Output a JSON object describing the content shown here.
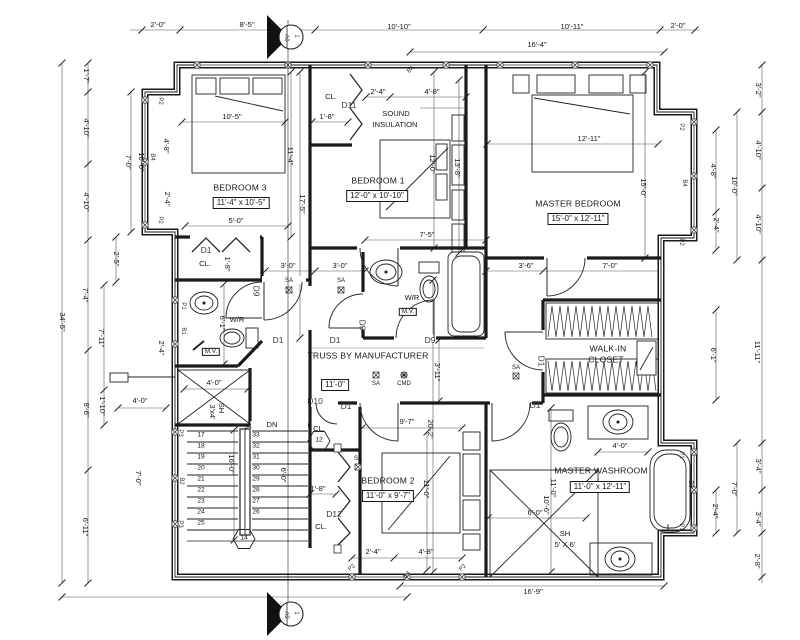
{
  "drawing": {
    "type": "architectural-floor-plan",
    "ink_color": "#1a1a1a",
    "paper_color": "#ffffff",
    "section_marker": {
      "number": "1",
      "sheet": "A9"
    }
  },
  "labels": [
    {
      "t": "BEDROOM 3",
      "x": 240,
      "y": 188,
      "c": "room",
      "n": "room-label-bedroom-3"
    },
    {
      "t": "11'-4\" x 10'-5\"",
      "x": 241,
      "y": 203,
      "c": "roombox",
      "n": "room-size-bedroom-3"
    },
    {
      "t": "BEDROOM 1",
      "x": 378,
      "y": 181,
      "c": "room",
      "n": "room-label-bedroom-1"
    },
    {
      "t": "12'-0\" x 10'-10\"",
      "x": 377,
      "y": 196,
      "c": "roombox",
      "n": "room-size-bedroom-1"
    },
    {
      "t": "MASTER BEDROOM",
      "x": 578,
      "y": 204,
      "c": "room",
      "n": "room-label-master-bedroom"
    },
    {
      "t": "15'-0\" x 12'-11\"",
      "x": 578,
      "y": 219,
      "c": "roombox",
      "n": "room-size-master-bedroom"
    },
    {
      "t": "BEDROOM 2",
      "x": 388,
      "y": 481,
      "c": "room",
      "n": "room-label-bedroom-2"
    },
    {
      "t": "11'-0\" x 9'-7\"",
      "x": 388,
      "y": 496,
      "c": "roombox",
      "n": "room-size-bedroom-2"
    },
    {
      "t": "MASTER WASHROOM",
      "x": 601,
      "y": 471,
      "c": "room",
      "n": "room-label-master-washroom"
    },
    {
      "t": "11'-0\" x 12'-11\"",
      "x": 600,
      "y": 487,
      "c": "roombox",
      "n": "room-size-master-washroom"
    },
    {
      "t": "WALK-IN",
      "x": 608,
      "y": 349,
      "c": "room",
      "n": "room-label-walk-in-closet"
    },
    {
      "t": "CLOSET",
      "x": 606,
      "y": 360,
      "c": "room"
    },
    {
      "t": "SOUND",
      "x": 396,
      "y": 114,
      "c": "dim",
      "n": "note-sound-insulation"
    },
    {
      "t": "INSULATION",
      "x": 395,
      "y": 125,
      "c": "dim"
    },
    {
      "t": "TRUSS BY MANUFACTURER",
      "x": 368,
      "y": 356,
      "c": "room",
      "n": "note-truss"
    },
    {
      "t": "11'-0\"",
      "x": 335,
      "y": 385,
      "c": "roombox",
      "n": "hall-width-dim"
    },
    {
      "t": "2'-0\"",
      "x": 158,
      "y": 25,
      "c": "dim"
    },
    {
      "t": "8'-5\"",
      "x": 247,
      "y": 25,
      "c": "dim"
    },
    {
      "t": "10'-10\"",
      "x": 399,
      "y": 27,
      "c": "dim"
    },
    {
      "t": "10'-11\"",
      "x": 572,
      "y": 27,
      "c": "dim"
    },
    {
      "t": "2'-0\"",
      "x": 678,
      "y": 26,
      "c": "dim"
    },
    {
      "t": "16'-4\"",
      "x": 537,
      "y": 45,
      "c": "dim"
    },
    {
      "t": "1'-7\"",
      "x": 86,
      "y": 76,
      "c": "dim",
      "r": 90
    },
    {
      "t": "4'-10\"",
      "x": 86,
      "y": 128,
      "c": "dim",
      "r": 90
    },
    {
      "t": "4'-10\"",
      "x": 86,
      "y": 202,
      "c": "dim",
      "r": 90
    },
    {
      "t": "7'-4\"",
      "x": 85,
      "y": 295,
      "c": "dim",
      "r": 90
    },
    {
      "t": "8'-6\"",
      "x": 86,
      "y": 410,
      "c": "dim",
      "r": 90
    },
    {
      "t": "6'-11\"",
      "x": 85,
      "y": 527,
      "c": "dim",
      "r": 90
    },
    {
      "t": "34'-5\"",
      "x": 62,
      "y": 322,
      "c": "dim",
      "r": 90
    },
    {
      "t": "2'-5\"",
      "x": 116,
      "y": 259,
      "c": "dim",
      "r": 90
    },
    {
      "t": "7'-11\"",
      "x": 101,
      "y": 338,
      "c": "dim",
      "r": 90
    },
    {
      "t": "1'-10\"",
      "x": 102,
      "y": 406,
      "c": "dim",
      "r": 90
    },
    {
      "t": "7'-0\"",
      "x": 128,
      "y": 162,
      "c": "dim",
      "r": 90
    },
    {
      "t": "10'-0\"",
      "x": 141,
      "y": 162,
      "c": "dim",
      "r": 90
    },
    {
      "t": "4'-8\"",
      "x": 166,
      "y": 146,
      "c": "dim",
      "r": 90
    },
    {
      "t": "2'-4\"",
      "x": 167,
      "y": 199,
      "c": "dim",
      "r": 90
    },
    {
      "t": "2'-4\"",
      "x": 161,
      "y": 348,
      "c": "dim",
      "r": 90
    },
    {
      "t": "7'-0\"",
      "x": 138,
      "y": 478,
      "c": "dim",
      "r": 90
    },
    {
      "t": "4'-0\"",
      "x": 140,
      "y": 401,
      "c": "dim"
    },
    {
      "t": "3'-2\"",
      "x": 758,
      "y": 90,
      "c": "dim",
      "r": 90
    },
    {
      "t": "4'-10\"",
      "x": 758,
      "y": 150,
      "c": "dim",
      "r": 90
    },
    {
      "t": "4'-10\"",
      "x": 758,
      "y": 224,
      "c": "dim",
      "r": 90
    },
    {
      "t": "11'-11\"",
      "x": 757,
      "y": 352,
      "c": "dim",
      "r": 90
    },
    {
      "t": "3'-4\"",
      "x": 758,
      "y": 466,
      "c": "dim",
      "r": 90
    },
    {
      "t": "3'-4\"",
      "x": 758,
      "y": 519,
      "c": "dim",
      "r": 90
    },
    {
      "t": "2'-8\"",
      "x": 757,
      "y": 561,
      "c": "dim",
      "r": 90
    },
    {
      "t": "10'-0\"",
      "x": 734,
      "y": 186,
      "c": "dim",
      "r": 90
    },
    {
      "t": "7'-0\"",
      "x": 734,
      "y": 489,
      "c": "dim",
      "r": 90
    },
    {
      "t": "4'-8\"",
      "x": 713,
      "y": 171,
      "c": "dim",
      "r": 90
    },
    {
      "t": "2'-4\"",
      "x": 716,
      "y": 225,
      "c": "dim",
      "r": 90
    },
    {
      "t": "6'-1\"",
      "x": 713,
      "y": 355,
      "c": "dim",
      "r": 90
    },
    {
      "t": "2'-4\"",
      "x": 715,
      "y": 511,
      "c": "dim",
      "r": 90
    },
    {
      "t": "16'-9\"",
      "x": 533,
      "y": 592,
      "c": "dim"
    },
    {
      "t": "2'-4\"",
      "x": 373,
      "y": 552,
      "c": "dim"
    },
    {
      "t": "4'-8\"",
      "x": 426,
      "y": 552,
      "c": "dim"
    },
    {
      "t": "2'-4\"",
      "x": 378,
      "y": 92,
      "c": "dim"
    },
    {
      "t": "4'-8\"",
      "x": 432,
      "y": 92,
      "c": "dim"
    },
    {
      "t": "10'-5\"",
      "x": 232,
      "y": 117,
      "c": "dim"
    },
    {
      "t": "1'-8\"",
      "x": 327,
      "y": 117,
      "c": "dim"
    },
    {
      "t": "5'-0\"",
      "x": 236,
      "y": 221,
      "c": "dim"
    },
    {
      "t": "7'-5\"",
      "x": 427,
      "y": 235,
      "c": "dim"
    },
    {
      "t": "12'-11\"",
      "x": 589,
      "y": 139,
      "c": "dim"
    },
    {
      "t": "3'-0\"",
      "x": 288,
      "y": 266,
      "c": "dim"
    },
    {
      "t": "3'-0\"",
      "x": 340,
      "y": 266,
      "c": "dim"
    },
    {
      "t": "3'-6\"",
      "x": 526,
      "y": 266,
      "c": "dim"
    },
    {
      "t": "7'-0\"",
      "x": 610,
      "y": 266,
      "c": "dim"
    },
    {
      "t": "9'-7\"",
      "x": 407,
      "y": 422,
      "c": "dim"
    },
    {
      "t": "4'-0\"",
      "x": 214,
      "y": 383,
      "c": "dim"
    },
    {
      "t": "4'-0\"",
      "x": 620,
      "y": 446,
      "c": "dim"
    },
    {
      "t": "6'-0\"",
      "x": 535,
      "y": 513,
      "c": "dim"
    },
    {
      "t": "1'-8\"",
      "x": 318,
      "y": 489,
      "c": "dim"
    },
    {
      "t": "11'-4\"",
      "x": 290,
      "y": 156,
      "c": "dim",
      "r": 90
    },
    {
      "t": "17'-5\"",
      "x": 302,
      "y": 204,
      "c": "dim",
      "r": 90
    },
    {
      "t": "12'-0\"",
      "x": 432,
      "y": 164,
      "c": "dim",
      "r": 90
    },
    {
      "t": "13'-8\"",
      "x": 457,
      "y": 168,
      "c": "dim",
      "r": 90
    },
    {
      "t": "15'-0\"",
      "x": 643,
      "y": 188,
      "c": "dim",
      "r": 90
    },
    {
      "t": "1'-8\"",
      "x": 227,
      "y": 264,
      "c": "dim",
      "r": 90
    },
    {
      "t": "6'-1\"",
      "x": 222,
      "y": 323,
      "c": "dim",
      "r": 90
    },
    {
      "t": "3'-11\"",
      "x": 437,
      "y": 372,
      "c": "dim",
      "r": 90
    },
    {
      "t": "20'-2\"",
      "x": 430,
      "y": 429,
      "c": "dim",
      "r": 90
    },
    {
      "t": "11'-0\"",
      "x": 426,
      "y": 489,
      "c": "dim",
      "r": 90
    },
    {
      "t": "16'-0\"",
      "x": 231,
      "y": 464,
      "c": "dim",
      "r": 90
    },
    {
      "t": "6'-0\"",
      "x": 283,
      "y": 475,
      "c": "dim",
      "r": 90
    },
    {
      "t": "10'-6\"",
      "x": 546,
      "y": 505,
      "c": "dim",
      "r": 90
    },
    {
      "t": "11'-0\"",
      "x": 553,
      "y": 488,
      "c": "dim",
      "r": 90
    },
    {
      "t": "SH",
      "x": 221,
      "y": 408,
      "c": "dim",
      "r": 90
    },
    {
      "t": "3'x4'",
      "x": 212,
      "y": 412,
      "c": "dim",
      "r": 90
    },
    {
      "t": "SH",
      "x": 565,
      "y": 534,
      "c": "dim",
      "n": "shower-label-master"
    },
    {
      "t": "5' X 6'",
      "x": 565,
      "y": 545,
      "c": "dim"
    },
    {
      "t": "CL.",
      "x": 205,
      "y": 264,
      "c": "dim",
      "n": "closet-label"
    },
    {
      "t": "CL.",
      "x": 331,
      "y": 97,
      "c": "dim",
      "n": "closet-label"
    },
    {
      "t": "CL.",
      "x": 319,
      "y": 429,
      "c": "dim",
      "n": "closet-label"
    },
    {
      "t": "CL.",
      "x": 321,
      "y": 527,
      "c": "dim",
      "n": "closet-label"
    },
    {
      "t": "W/R",
      "x": 237,
      "y": 320,
      "c": "dim",
      "n": "washroom-label"
    },
    {
      "t": "W/R",
      "x": 412,
      "y": 298,
      "c": "dim",
      "n": "washroom-label"
    },
    {
      "t": "M.V.",
      "x": 211,
      "y": 352,
      "c": "mvbox",
      "n": "mech-vent-label"
    },
    {
      "t": "M.V.",
      "x": 408,
      "y": 312,
      "c": "mvbox",
      "n": "mech-vent-label"
    },
    {
      "t": "DN",
      "x": 272,
      "y": 425,
      "c": "dim",
      "n": "stair-down-label"
    },
    {
      "t": "SA",
      "x": 289,
      "y": 281,
      "c": "sa",
      "n": "smoke-alarm"
    },
    {
      "t": "SA",
      "x": 341,
      "y": 281,
      "c": "sa",
      "n": "smoke-alarm"
    },
    {
      "t": "SA",
      "x": 376,
      "y": 384,
      "c": "sa",
      "n": "smoke-alarm"
    },
    {
      "t": "SA",
      "x": 516,
      "y": 368,
      "c": "sa",
      "n": "smoke-alarm"
    },
    {
      "t": "SA",
      "x": 358,
      "y": 459,
      "c": "sa",
      "n": "smoke-alarm"
    },
    {
      "t": "CMD",
      "x": 404,
      "y": 384,
      "c": "sa",
      "n": "carbon-monoxide-detector"
    },
    {
      "t": "D1",
      "x": 206,
      "y": 250,
      "c": "tag",
      "n": "door-tag"
    },
    {
      "t": "D11",
      "x": 349,
      "y": 105,
      "c": "tag",
      "n": "door-tag"
    },
    {
      "t": "D1",
      "x": 278,
      "y": 340,
      "c": "tag",
      "n": "door-tag"
    },
    {
      "t": "D1",
      "x": 335,
      "y": 340,
      "c": "tag",
      "n": "door-tag"
    },
    {
      "t": "D9",
      "x": 430,
      "y": 340,
      "c": "tag",
      "n": "door-tag"
    },
    {
      "t": "D9",
      "x": 256,
      "y": 291,
      "c": "tag",
      "r": 90,
      "n": "door-tag"
    },
    {
      "t": "D9",
      "x": 362,
      "y": 325,
      "c": "tag",
      "r": 90,
      "n": "door-tag"
    },
    {
      "t": "D10",
      "x": 315,
      "y": 401,
      "c": "tag",
      "n": "door-tag"
    },
    {
      "t": "D1",
      "x": 346,
      "y": 406,
      "c": "tag",
      "n": "door-tag"
    },
    {
      "t": "D12",
      "x": 334,
      "y": 514,
      "c": "tag",
      "n": "door-tag"
    },
    {
      "t": "D1",
      "x": 535,
      "y": 405,
      "c": "tag",
      "n": "door-tag"
    },
    {
      "t": "D1",
      "x": 541,
      "y": 361,
      "c": "tag",
      "r": 90,
      "n": "door-tag"
    },
    {
      "t": "B4",
      "x": 411,
      "y": 70,
      "c": "tiny",
      "r": -45,
      "n": "window-tag"
    },
    {
      "t": "B4",
      "x": 407,
      "y": 575,
      "c": "tiny",
      "r": -45,
      "n": "window-tag"
    },
    {
      "t": "B4",
      "x": 152,
      "y": 157,
      "c": "tiny",
      "r": 90,
      "n": "window-tag"
    },
    {
      "t": "B4",
      "x": 684,
      "y": 183,
      "c": "tiny",
      "r": 90,
      "n": "window-tag"
    },
    {
      "t": "B2",
      "x": 181,
      "y": 481,
      "c": "tiny",
      "r": 90,
      "n": "window-tag"
    },
    {
      "t": "B3",
      "x": 690,
      "y": 484,
      "c": "tiny",
      "r": 90,
      "n": "window-tag"
    },
    {
      "t": "B1",
      "x": 183,
      "y": 331,
      "c": "tiny",
      "r": 90,
      "n": "window-tag"
    },
    {
      "t": "P1",
      "x": 183,
      "y": 306,
      "c": "tiny",
      "r": 90,
      "n": "window-tag"
    },
    {
      "t": "P2",
      "x": 160,
      "y": 101,
      "c": "tiny",
      "r": 90,
      "n": "window-tag"
    },
    {
      "t": "P2",
      "x": 160,
      "y": 220,
      "c": "tiny",
      "r": 90,
      "n": "window-tag"
    },
    {
      "t": "P2",
      "x": 681,
      "y": 127,
      "c": "tiny",
      "r": 90,
      "n": "window-tag"
    },
    {
      "t": "P2",
      "x": 681,
      "y": 242,
      "c": "tiny",
      "r": 90,
      "n": "window-tag"
    },
    {
      "t": "P3",
      "x": 180,
      "y": 433,
      "c": "tiny",
      "r": 90,
      "n": "window-tag"
    },
    {
      "t": "P3",
      "x": 180,
      "y": 524,
      "c": "tiny",
      "r": 90,
      "n": "window-tag"
    },
    {
      "t": "P1",
      "x": 681,
      "y": 455,
      "c": "tiny",
      "r": 90,
      "n": "window-tag"
    },
    {
      "t": "P1",
      "x": 681,
      "y": 527,
      "c": "tiny",
      "r": 90,
      "n": "window-tag"
    },
    {
      "t": "P2",
      "x": 352,
      "y": 568,
      "c": "tiny",
      "r": -45,
      "n": "window-tag"
    },
    {
      "t": "P2",
      "x": 463,
      "y": 568,
      "c": "tiny",
      "r": -45,
      "n": "window-tag"
    },
    {
      "t": "17",
      "x": 201,
      "y": 436,
      "c": "stair",
      "n": "stair-number"
    },
    {
      "t": "18",
      "x": 201,
      "y": 447,
      "c": "stair",
      "n": "stair-number"
    },
    {
      "t": "19",
      "x": 201,
      "y": 458,
      "c": "stair",
      "n": "stair-number"
    },
    {
      "t": "20",
      "x": 201,
      "y": 469,
      "c": "stair",
      "n": "stair-number"
    },
    {
      "t": "21",
      "x": 201,
      "y": 480,
      "c": "stair",
      "n": "stair-number"
    },
    {
      "t": "22",
      "x": 201,
      "y": 491,
      "c": "stair",
      "n": "stair-number"
    },
    {
      "t": "23",
      "x": 201,
      "y": 502,
      "c": "stair",
      "n": "stair-number"
    },
    {
      "t": "24",
      "x": 201,
      "y": 513,
      "c": "stair",
      "n": "stair-number"
    },
    {
      "t": "25",
      "x": 201,
      "y": 524,
      "c": "stair",
      "n": "stair-number"
    },
    {
      "t": "34",
      "x": 248,
      "y": 428,
      "c": "stair",
      "n": "stair-number"
    },
    {
      "t": "33",
      "x": 256,
      "y": 436,
      "c": "stair",
      "n": "stair-number"
    },
    {
      "t": "32",
      "x": 256,
      "y": 447,
      "c": "stair",
      "n": "stair-number"
    },
    {
      "t": "31",
      "x": 256,
      "y": 458,
      "c": "stair",
      "n": "stair-number"
    },
    {
      "t": "30",
      "x": 256,
      "y": 469,
      "c": "stair",
      "n": "stair-number"
    },
    {
      "t": "29",
      "x": 256,
      "y": 480,
      "c": "stair",
      "n": "stair-number"
    },
    {
      "t": "28",
      "x": 256,
      "y": 491,
      "c": "stair",
      "n": "stair-number"
    },
    {
      "t": "27",
      "x": 256,
      "y": 502,
      "c": "stair",
      "n": "stair-number"
    },
    {
      "t": "26",
      "x": 256,
      "y": 513,
      "c": "stair",
      "n": "stair-number"
    },
    {
      "t": "12",
      "x": 319,
      "y": 441,
      "c": "stair",
      "n": "tag-hexagon-12"
    },
    {
      "t": "14",
      "x": 244,
      "y": 539,
      "c": "stair",
      "n": "tag-hexagon-14"
    },
    {
      "t": "1",
      "x": 296,
      "y": 36,
      "c": "tiny",
      "r": 90,
      "n": "section-marker-number"
    },
    {
      "t": "A9",
      "x": 286,
      "y": 38,
      "c": "tiny",
      "r": 90,
      "n": "section-marker-sheet"
    },
    {
      "t": "1",
      "x": 296,
      "y": 613,
      "c": "tiny",
      "r": 90,
      "n": "section-marker-number"
    },
    {
      "t": "A9",
      "x": 286,
      "y": 615,
      "c": "tiny",
      "r": 90,
      "n": "section-marker-sheet"
    }
  ]
}
